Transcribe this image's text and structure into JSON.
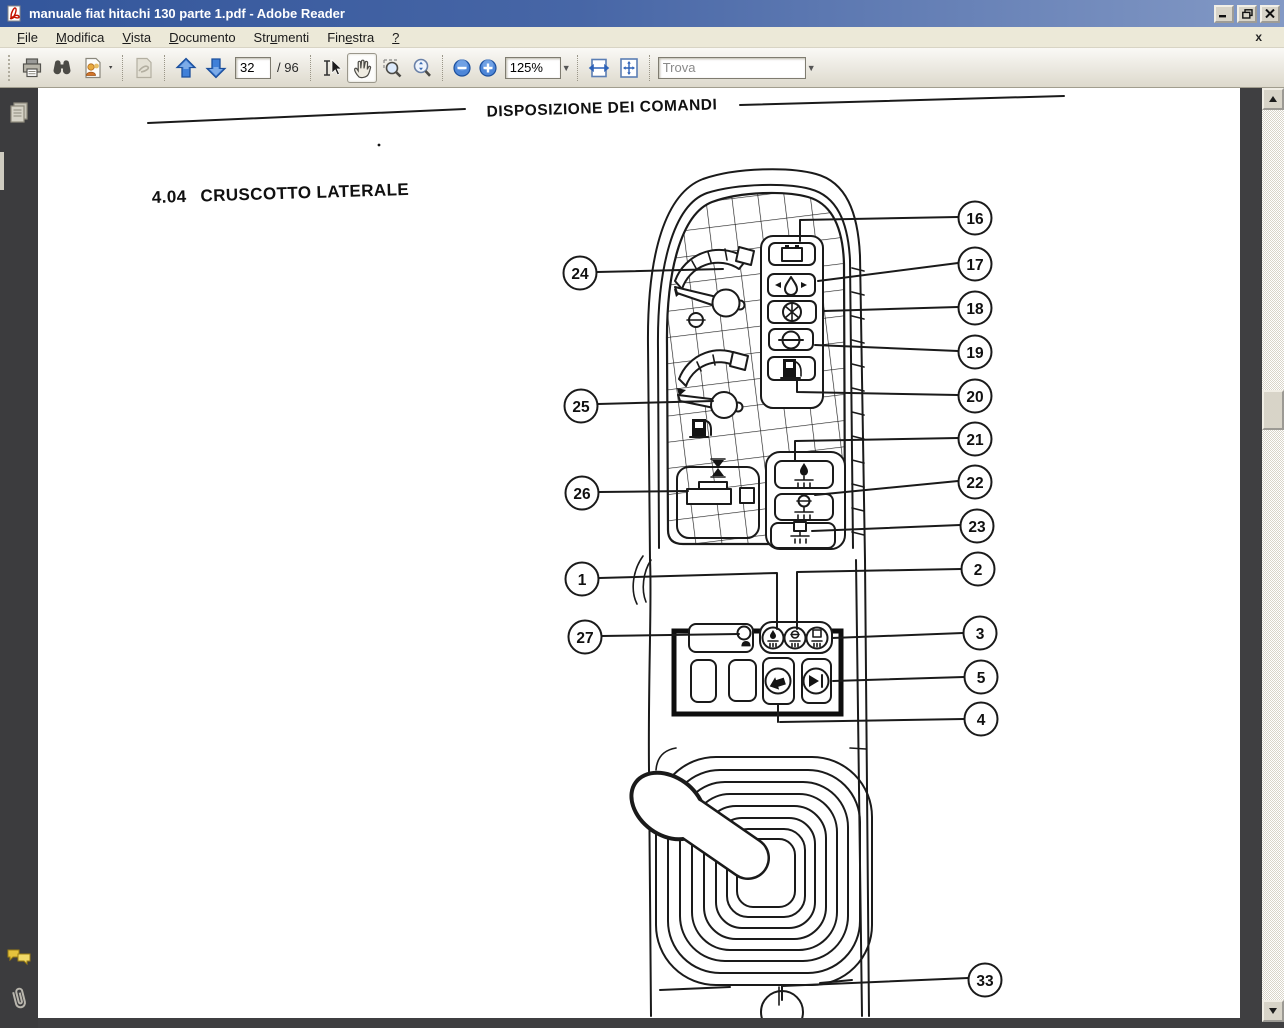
{
  "window": {
    "title": "manuale fiat hitachi 130 parte 1.pdf - Adobe Reader"
  },
  "menu": {
    "items": [
      {
        "pre": "",
        "key": "F",
        "post": "ile"
      },
      {
        "pre": "",
        "key": "M",
        "post": "odifica"
      },
      {
        "pre": "",
        "key": "V",
        "post": "ista"
      },
      {
        "pre": "",
        "key": "D",
        "post": "ocumento"
      },
      {
        "pre": "Str",
        "key": "u",
        "post": "menti"
      },
      {
        "pre": "Fin",
        "key": "e",
        "post": "stra"
      },
      {
        "pre": "",
        "key": "?",
        "post": ""
      }
    ],
    "close_glyph": "x"
  },
  "toolbar": {
    "page_current": "32",
    "page_divider": "/",
    "page_total": "96",
    "zoom_level": "125%",
    "find_placeholder": "Trova",
    "icons": [
      "print",
      "search-binoculars",
      "collaborate",
      "sign",
      "page-up",
      "page-down",
      "select-tool",
      "hand-tool",
      "marquee-zoom",
      "dynamic-zoom",
      "zoom-out",
      "zoom-in",
      "fit-width",
      "fit-page",
      "find-dropdown"
    ]
  },
  "nav": {
    "icons": [
      "pages-panel",
      "comments-panel",
      "attachments-panel"
    ]
  },
  "document": {
    "header": "DISPOSIZIONE DEI COMANDI",
    "section_number": "4.04",
    "section_title": "CRUSCOTTO LATERALE",
    "callout_labels": [
      "1",
      "2",
      "3",
      "4",
      "5",
      "16",
      "17",
      "18",
      "19",
      "20",
      "21",
      "22",
      "23",
      "24",
      "25",
      "26",
      "27",
      "33"
    ],
    "indicator_icons": [
      "battery",
      "engine-oil-pressure",
      "coolant-temperature",
      "air-filter",
      "fuel-pump",
      "hydraulic-oil-level",
      "coolant-level",
      "battery-fluid-level",
      "alarm-lamp-display",
      "horn",
      "wiper"
    ]
  }
}
